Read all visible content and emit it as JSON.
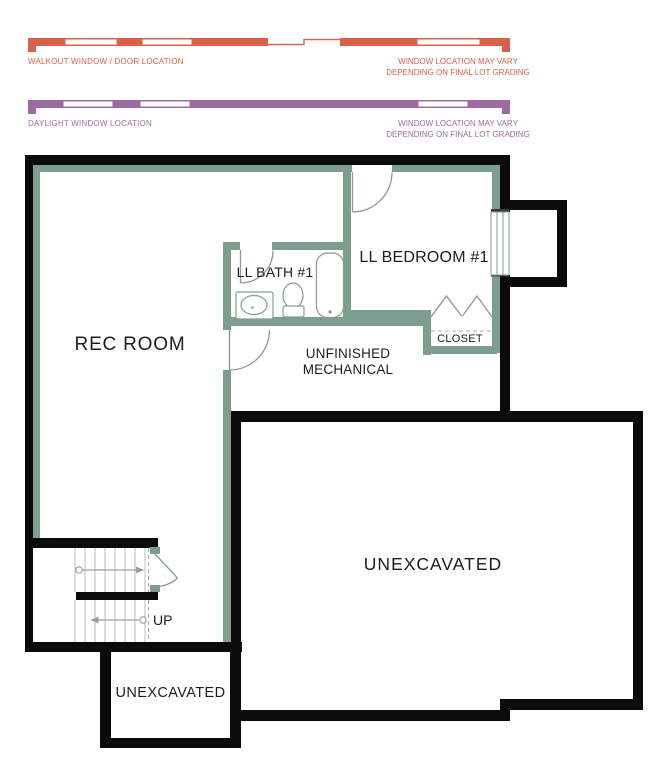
{
  "legend": {
    "walkout_label": "WALKOUT WINDOW / DOOR LOCATION",
    "walkout_note_line1": "WINDOW LOCATION MAY VARY",
    "walkout_note_line2": "DEPENDING ON FINAL LOT GRADING",
    "daylight_label": "DAYLIGHT WINDOW LOCATION",
    "daylight_note_line1": "WINDOW LOCATION MAY VARY",
    "daylight_note_line2": "DEPENDING ON FINAL LOT GRADING"
  },
  "rooms": {
    "rec_room": "REC ROOM",
    "bath": "LL BATH #1",
    "bedroom": "LL BEDROOM #1",
    "mechanical_line1": "UNFINISHED",
    "mechanical_line2": "MECHANICAL",
    "closet": "CLOSET",
    "unexcavated_main": "UNEXCAVATED",
    "unexcavated_small": "UNEXCAVATED",
    "stair_direction": "UP"
  },
  "colors": {
    "walkout": "#d96049",
    "daylight": "#9d6b9d",
    "wall": "#0b0b0b",
    "green": "#7b9e8e",
    "text": "#1d1d1d",
    "line": "#8a9a94"
  }
}
